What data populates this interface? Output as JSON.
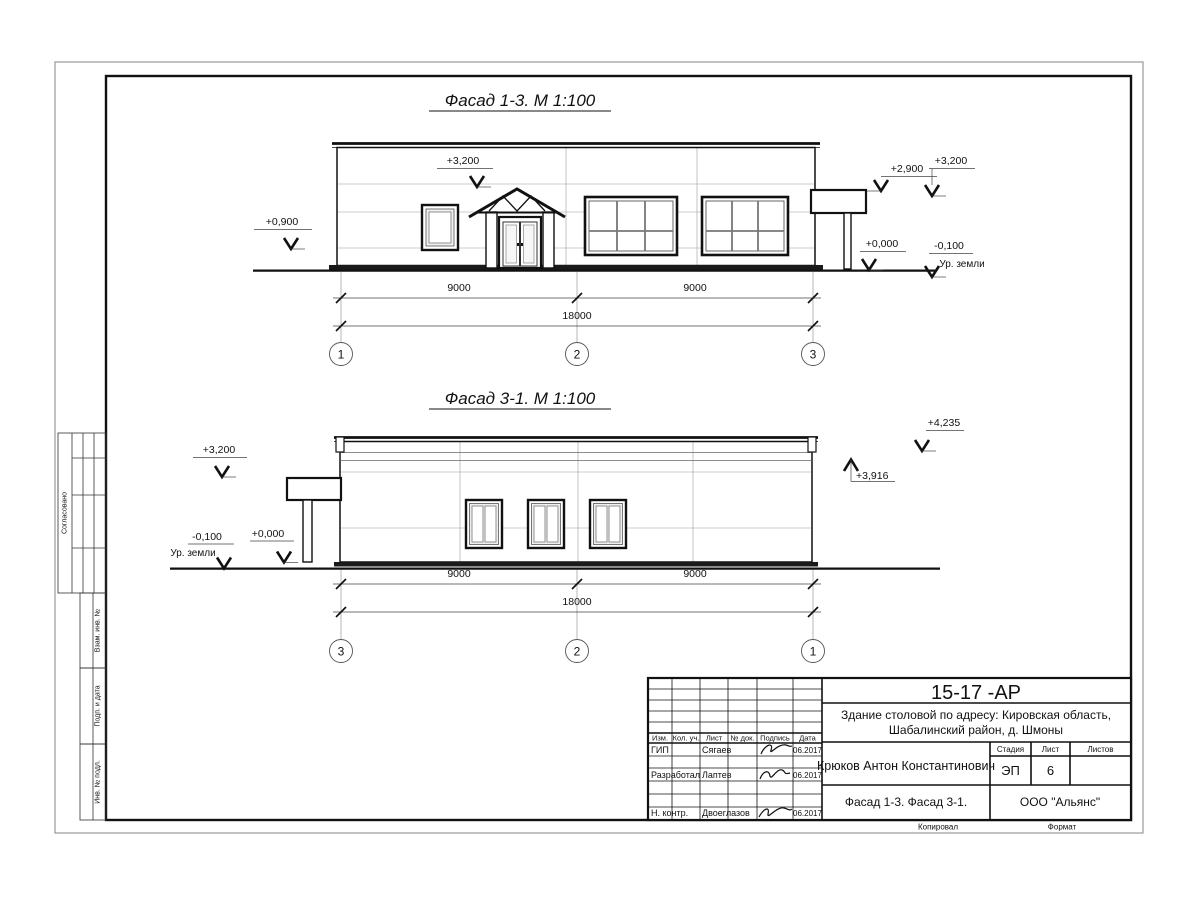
{
  "facade1": {
    "title": "Фасад 1-3.  М 1:100",
    "dim_left": "9000",
    "dim_right": "9000",
    "dim_total": "18000",
    "axis_left": "1",
    "axis_mid": "2",
    "axis_right": "3",
    "mark_0900": "+0,900",
    "mark_3200_mid": "+3,200",
    "mark_2900": "+2,900",
    "mark_3200_right": "+3,200",
    "mark_0000": "+0,000",
    "mark_minus_0100": "-0,100",
    "ground_label": "Ур. земли"
  },
  "facade2": {
    "title": "Фасад 3-1.  М 1:100",
    "dim_left": "9000",
    "dim_right": "9000",
    "dim_total": "18000",
    "axis_left": "3",
    "axis_mid": "2",
    "axis_right": "1",
    "mark_3200": "+3,200",
    "mark_minus_0100": "-0,100",
    "ground_label": "Ур. земли",
    "mark_0000": "+0,000",
    "mark_3916": "+3,916",
    "mark_4235": "+4,235"
  },
  "side_stamps": {
    "approved": "Согласовано",
    "vzam": "Взам. инв. №",
    "podp": "Подп. и дата",
    "inv": "Инв. № подл."
  },
  "title_block": {
    "doc_number": "15-17 -АР",
    "object_line1": "Здание столовой по адресу: Кировская область,",
    "object_line2": "Шабалинский район, д. Шмоны",
    "header_cols": [
      "Изм.",
      "Кол. уч.",
      "Лист",
      "№ док.",
      "Подпись",
      "Дата"
    ],
    "rows": [
      {
        "role": "ГИП",
        "name": "Сягаев",
        "date": "06.2017"
      },
      {
        "role": "Разработал",
        "name": "Лаптев",
        "date": "06.2017"
      },
      {
        "role": "Н. контр.",
        "name": "Двоеглазов",
        "date": "06.2017"
      }
    ],
    "author": "Крюков Антон Константинович",
    "stage_label": "Стадия",
    "sheet_label": "Лист",
    "sheets_label": "Листов",
    "stage_value": "ЭП",
    "sheet_value": "6",
    "drawing_title": "Фасад 1-3. Фасад 3-1.",
    "company": "ООО \"Альянс\"",
    "copied_label": "Копировал",
    "format_label": "Формат"
  }
}
